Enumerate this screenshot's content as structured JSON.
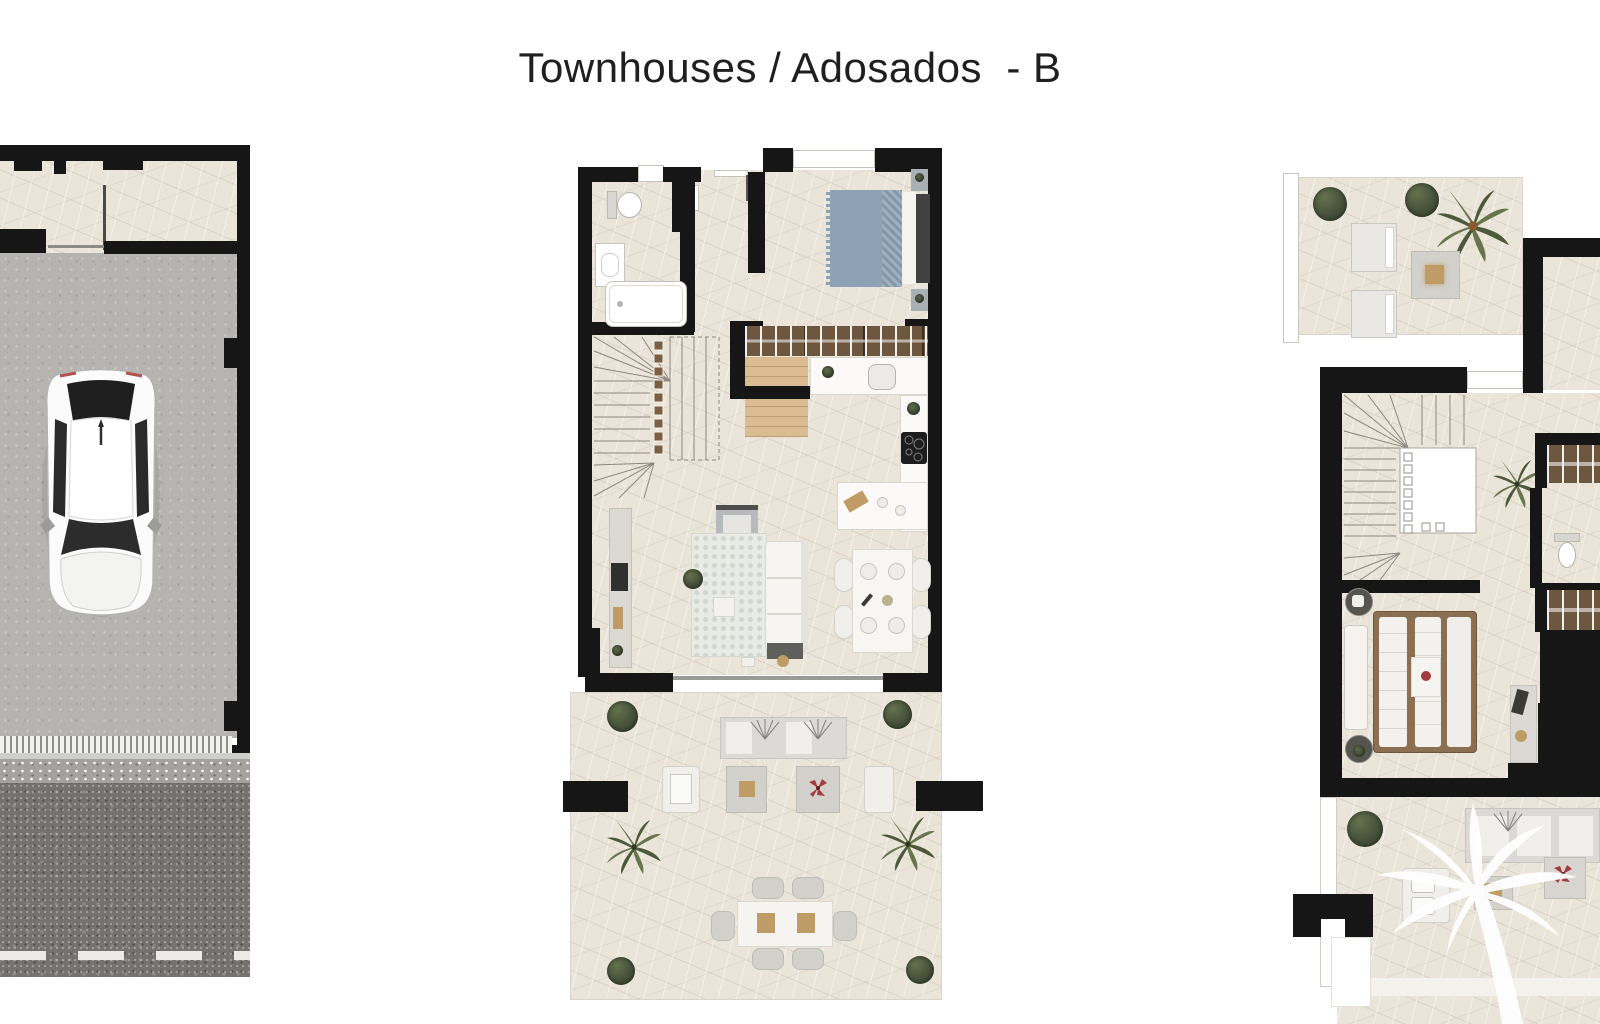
{
  "title": "Townhouses / Adosados  - B",
  "watermark_icon": "palm-tree-icon",
  "colors": {
    "title": "#1f1f1f",
    "wall": "#161616",
    "beige": "#eae4d9",
    "grey": "#b5b4b1",
    "asphalt": "#73726e",
    "speckle": "#a4a29e",
    "wood": "#dabb92",
    "wardrobe": "#6d573e",
    "bed_blue": "#8da2b5",
    "headboard": "#414141",
    "plant": "#4c5a39",
    "furn": "#d2d1cc",
    "tan": "#bf9c66",
    "red": "#a43b3f",
    "white": "#ffffff"
  }
}
